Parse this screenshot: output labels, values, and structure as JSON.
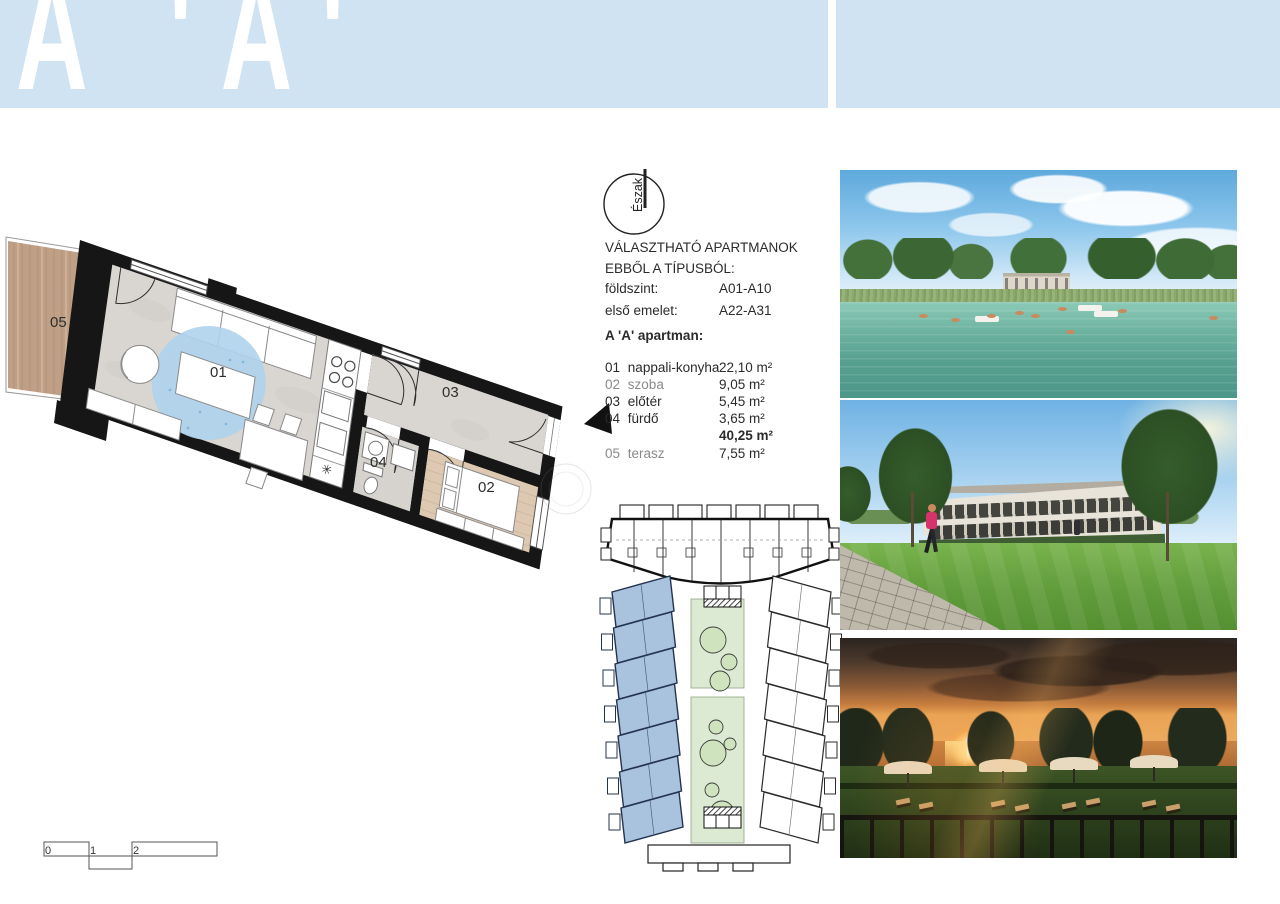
{
  "header": {
    "title": "A 'A'"
  },
  "north_label": "Észak",
  "availability": {
    "line1": "VÁLASZTHATÓ APARTMANOK",
    "line2": "EBBŐL A TÍPUSBÓL:",
    "ground_floor_label": "földszint:",
    "ground_floor_value": "A01-A10",
    "first_floor_label": "első emelet:",
    "first_floor_value": "A22-A31"
  },
  "apartment": {
    "heading": "A 'A' apartman:",
    "rooms": [
      {
        "num": "01",
        "name": "nappali-konyha",
        "area": "22,10 m²"
      },
      {
        "num": "02",
        "name": "szoba",
        "area": "9,05 m²"
      },
      {
        "num": "03",
        "name": "előtér",
        "area": "5,45 m²"
      },
      {
        "num": "04",
        "name": "fürdő",
        "area": "3,65 m²"
      }
    ],
    "total_area": "40,25 m²",
    "terrace": {
      "num": "05",
      "name": "terasz",
      "area": "7,55 m²"
    }
  },
  "floor_plan": {
    "room_labels": {
      "living": "01",
      "bedroom": "02",
      "hall": "03",
      "bath": "04",
      "terrace": "05"
    },
    "sink_symbol": "✳",
    "scale_bar": [
      "0",
      "1",
      "2",
      "4"
    ]
  },
  "colors": {
    "header_band": "#cfe3f2",
    "blue_units": "#a9c2de",
    "green_court": "#dcead3",
    "terrace_wood": "#bf9f85",
    "rug_blue": "#aed3ec"
  }
}
